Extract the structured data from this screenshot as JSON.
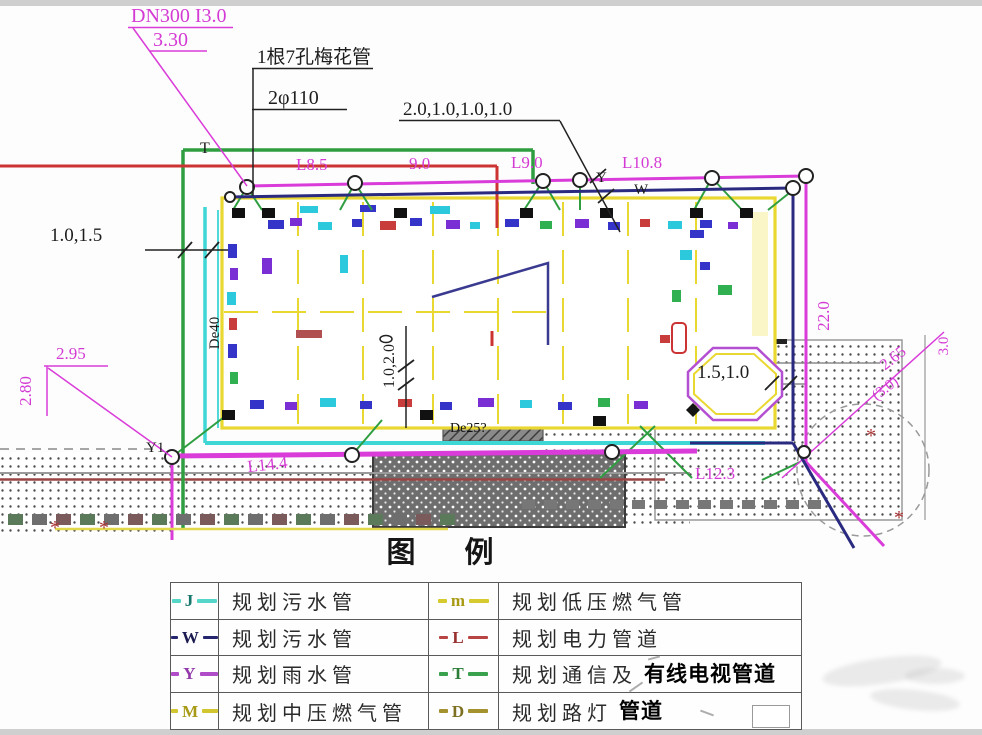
{
  "drawing": {
    "labels": {
      "dn300": "DN300 I3.0",
      "elev": "3.30",
      "plum_pipe": "1根7孔梅花管",
      "phi": "2φ110",
      "dims_top": "2.0,1.0,1.0,1.0",
      "t_marker": "T",
      "l85": "L8.5",
      "n90": "9.0",
      "l90": "L9.0",
      "l108": "L10.8",
      "y_marker": "Y",
      "w_marker": "W",
      "dims_left": "1.0,1.5",
      "de40": "De40",
      "d295": "2.95",
      "d280": "2.80",
      "y1": "Y1",
      "l144": "L14.4",
      "l123": "L12.3",
      "dims_v": "1.0,2.0",
      "de25": "De25?",
      "dims_r": "1.5,1.0",
      "l220": "22.0",
      "d265": "2.65",
      "d30a": "(3.0)",
      "d30b": "3.0"
    },
    "palette": {
      "magenta": "#d93cd9",
      "navy": "#2a2a80",
      "green": "#2e9e40",
      "cyan": "#3fd6d6",
      "red": "#cc3434",
      "yellow": "#ead832",
      "dark_red": "#9a4444"
    }
  },
  "legend": {
    "title": "图　例",
    "rows": [
      {
        "left": {
          "marker": "J",
          "color": "#55d6c8",
          "letter_color": "#17776d",
          "label": "规划污水管"
        },
        "right": {
          "marker": "m",
          "color": "#d6ca2e",
          "letter_color": "#a89a15",
          "label": "规划低压燃气管"
        }
      },
      {
        "left": {
          "marker": "W",
          "color": "#26266e",
          "letter_color": "#1b1b52",
          "label": "规划污水管"
        },
        "right": {
          "marker": "L",
          "color": "#b84444",
          "letter_color": "#983030",
          "label": "规划电力管道"
        }
      },
      {
        "left": {
          "marker": "Y",
          "color": "#b04cc8",
          "letter_color": "#9238aa",
          "label": "规划雨水管"
        },
        "right": {
          "marker": "T",
          "color": "#3aa14e",
          "letter_color": "#2c7d38",
          "label": "规划通信及",
          "label_bold": "有线电视管道"
        }
      },
      {
        "left": {
          "marker": "M",
          "color": "#d2c62e",
          "letter_color": "#a89a15",
          "label": "规划中压燃气管"
        },
        "right": {
          "marker": "D",
          "color": "#a3922e",
          "letter_color": "#7d7020",
          "label": "规划路灯",
          "label_bold": "管道"
        }
      }
    ]
  }
}
